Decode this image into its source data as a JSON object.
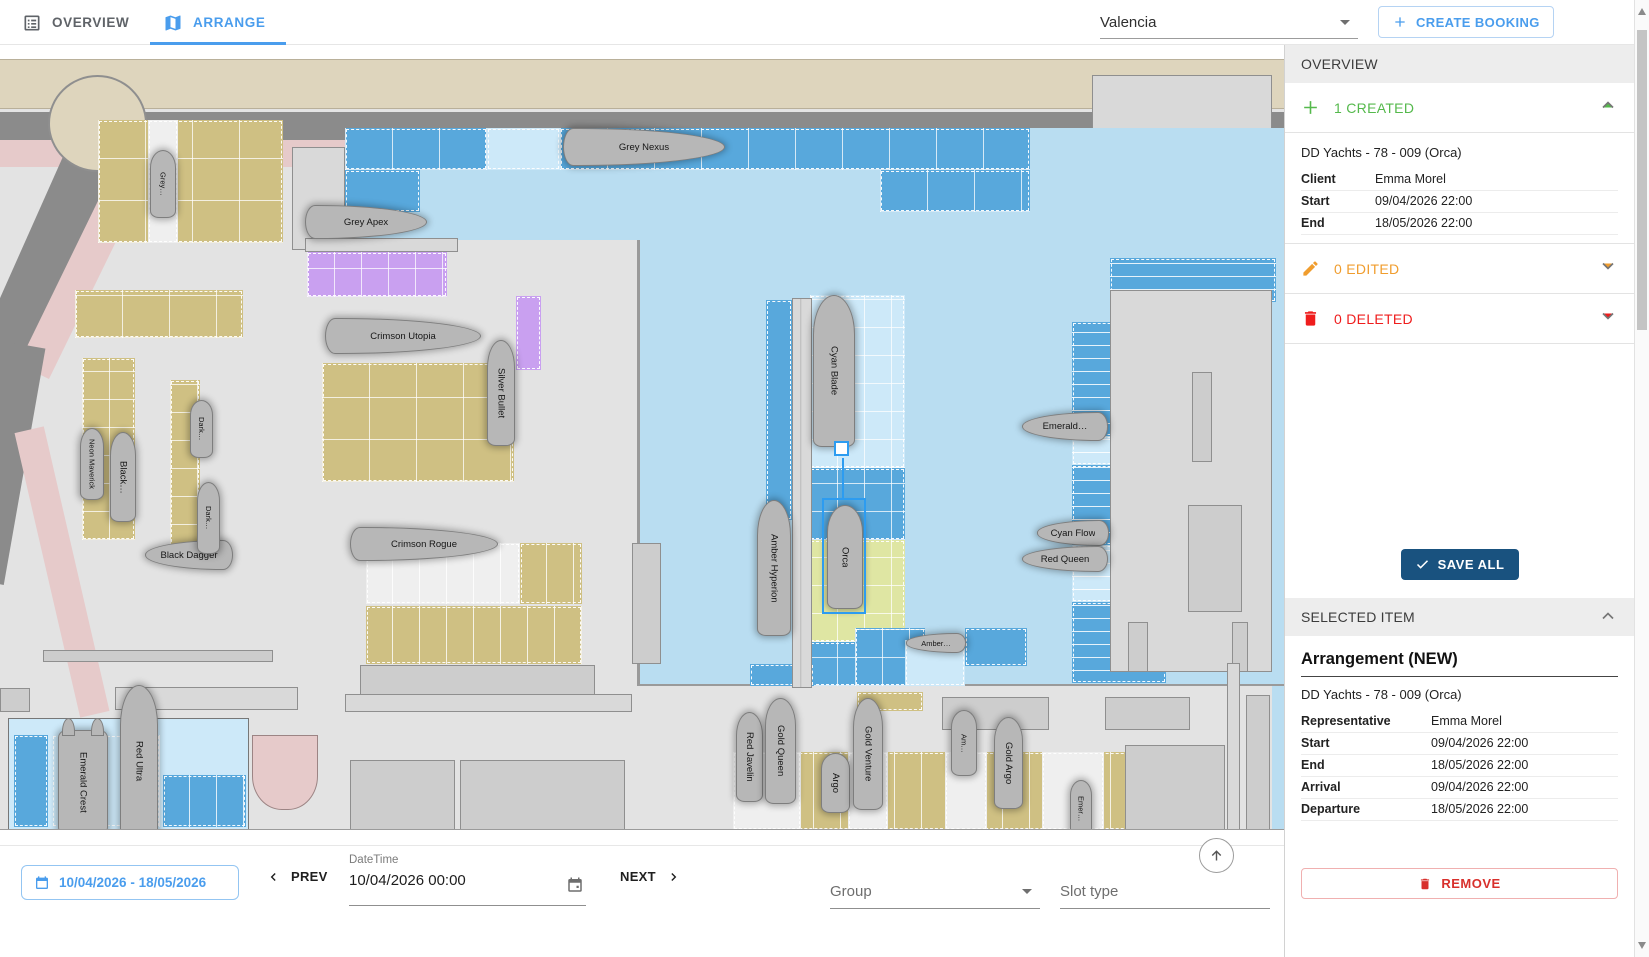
{
  "header": {
    "tabs": [
      {
        "label": "OVERVIEW"
      },
      {
        "label": "ARRANGE"
      }
    ],
    "marina_select": {
      "value": "Valencia"
    },
    "create_booking_label": "CREATE BOOKING"
  },
  "sidebar": {
    "overview_title": "OVERVIEW",
    "created_section": {
      "label": "1 CREATED"
    },
    "created_booking": {
      "title": "DD Yachts - 78 - 009 (Orca)",
      "rows": [
        [
          "Client",
          "Emma Morel"
        ],
        [
          "Start",
          "09/04/2026 22:00"
        ],
        [
          "End",
          "18/05/2026 22:00"
        ]
      ]
    },
    "edited_section": {
      "label": "0 EDITED"
    },
    "deleted_section": {
      "label": "0 DELETED"
    },
    "save_all_label": "SAVE ALL",
    "selected_item_title": "SELECTED ITEM",
    "arrangement": {
      "title": "Arrangement (NEW)",
      "subtitle": "DD Yachts - 78 - 009 (Orca)",
      "rows": [
        [
          "Representative",
          "Emma Morel"
        ],
        [
          "Start",
          "09/04/2026 22:00"
        ],
        [
          "End",
          "18/05/2026 22:00"
        ],
        [
          "Arrival",
          "09/04/2026 22:00"
        ],
        [
          "Departure",
          "18/05/2026 22:00"
        ]
      ]
    },
    "remove_label": "REMOVE"
  },
  "toolbar": {
    "date_range": "10/04/2026 - 18/05/2026",
    "prev_label": "PREV",
    "datetime_label": "DateTime",
    "datetime_value": "10/04/2026 00:00",
    "next_label": "NEXT",
    "group_label": "Group",
    "slot_type_label": "Slot type"
  },
  "map": {
    "selected_boat": "Orca",
    "boats": [
      {
        "name": "Grey…",
        "x": 150,
        "y": 105,
        "w": 26,
        "h": 68,
        "dir": "up",
        "small": true
      },
      {
        "name": "Grey Apex",
        "x": 305,
        "y": 160,
        "w": 122,
        "h": 34,
        "dir": "right"
      },
      {
        "name": "Grey Nexus",
        "x": 563,
        "y": 83,
        "w": 162,
        "h": 38,
        "dir": "right"
      },
      {
        "name": "Crimson Utopia",
        "x": 325,
        "y": 273,
        "w": 156,
        "h": 36,
        "dir": "right"
      },
      {
        "name": "Silver Bullet",
        "x": 487,
        "y": 295,
        "w": 28,
        "h": 106,
        "dir": "up"
      },
      {
        "name": "Crimson Rogue",
        "x": 350,
        "y": 482,
        "w": 148,
        "h": 34,
        "dir": "right"
      },
      {
        "name": "Black Dagger",
        "x": 145,
        "y": 495,
        "w": 88,
        "h": 30,
        "dir": "left"
      },
      {
        "name": "Neon Maverick",
        "x": 80,
        "y": 383,
        "w": 24,
        "h": 72,
        "dir": "up",
        "small": true
      },
      {
        "name": "Black…",
        "x": 110,
        "y": 387,
        "w": 26,
        "h": 90,
        "dir": "up"
      },
      {
        "name": "Dark…",
        "x": 190,
        "y": 355,
        "w": 23,
        "h": 58,
        "dir": "up",
        "small": true
      },
      {
        "name": "Dark…",
        "x": 197,
        "y": 437,
        "w": 23,
        "h": 72,
        "dir": "up",
        "small": true
      },
      {
        "name": "Cyan Blade",
        "x": 813,
        "y": 250,
        "w": 42,
        "h": 152,
        "dir": "up"
      },
      {
        "name": "Orca",
        "x": 827,
        "y": 460,
        "w": 36,
        "h": 104,
        "dir": "up",
        "selected": true
      },
      {
        "name": "Amber Hyperion",
        "x": 757,
        "y": 455,
        "w": 34,
        "h": 136,
        "dir": "up"
      },
      {
        "name": "Emerald…",
        "x": 1022,
        "y": 367,
        "w": 86,
        "h": 29,
        "dir": "left"
      },
      {
        "name": "Cyan Flow",
        "x": 1037,
        "y": 475,
        "w": 72,
        "h": 26,
        "dir": "left"
      },
      {
        "name": "Red Queen",
        "x": 1022,
        "y": 501,
        "w": 86,
        "h": 26,
        "dir": "left"
      },
      {
        "name": "Amber…",
        "x": 906,
        "y": 588,
        "w": 60,
        "h": 20,
        "dir": "left",
        "small": true
      },
      {
        "name": "Red Javelin",
        "x": 736,
        "y": 667,
        "w": 27,
        "h": 90,
        "dir": "up"
      },
      {
        "name": "Gold Queen",
        "x": 765,
        "y": 653,
        "w": 31,
        "h": 106,
        "dir": "up"
      },
      {
        "name": "Argo",
        "x": 821,
        "y": 708,
        "w": 29,
        "h": 60,
        "dir": "up"
      },
      {
        "name": "Gold Venture",
        "x": 853,
        "y": 653,
        "w": 30,
        "h": 112,
        "dir": "up"
      },
      {
        "name": "Am…",
        "x": 951,
        "y": 665,
        "w": 26,
        "h": 66,
        "dir": "up",
        "small": true
      },
      {
        "name": "Gold Argo",
        "x": 994,
        "y": 672,
        "w": 29,
        "h": 92,
        "dir": "up"
      },
      {
        "name": "Emer…",
        "x": 1070,
        "y": 735,
        "w": 22,
        "h": 58,
        "dir": "up",
        "small": true
      },
      {
        "name": "Emerald Crest",
        "x": 58,
        "y": 685,
        "w": 50,
        "h": 105,
        "dir": "up",
        "cat": true
      },
      {
        "name": "Red Ultra",
        "x": 120,
        "y": 640,
        "w": 38,
        "h": 153,
        "dir": "up"
      }
    ]
  },
  "colors": {
    "accent_blue": "#4a9ded",
    "created_green": "#55b94c",
    "edited_orange": "#f09d2e",
    "deleted_red": "#ef1d1d",
    "save_navy": "#19527f",
    "selection_blue": "#2d9cf0",
    "water": "#b9ddf1",
    "slot_blue": "#58a8dc",
    "slot_tan": "#cfc083",
    "slot_purple": "#c9a0f0",
    "slot_yellow": "#dfe6a3"
  }
}
